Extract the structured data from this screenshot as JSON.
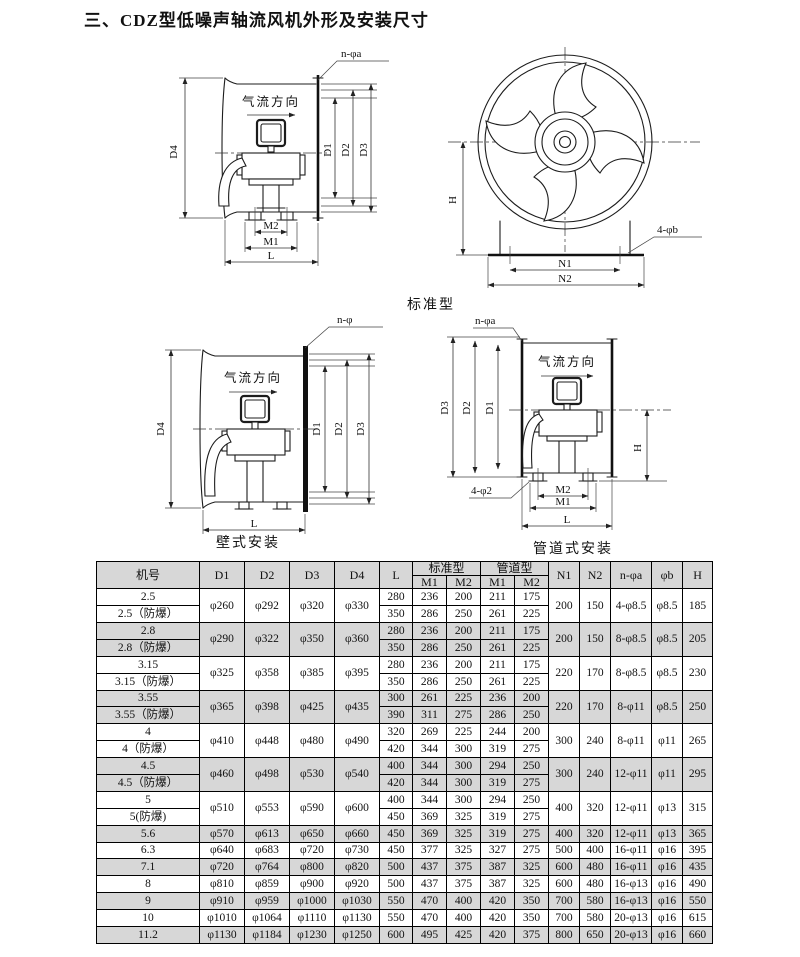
{
  "title": "三、CDZ型低噪声轴流风机外形及安装尺寸",
  "captions": {
    "standard": "标准型",
    "wall": "壁式安装",
    "duct": "管道式安装"
  },
  "labels": {
    "airflow": "气流方向",
    "std": {
      "bolt": "n-φa",
      "d4": "D4",
      "d1": "D1",
      "d2": "D2",
      "d3": "D3",
      "m2": "M2",
      "m1": "M1",
      "l": "L"
    },
    "front": {
      "h": "H",
      "n1": "N1",
      "n2": "N2",
      "bolt": "4-φb"
    },
    "wall": {
      "bolt": "n-φ",
      "d4": "D4",
      "d1": "D1",
      "d2": "D2",
      "d3": "D3",
      "l": "L"
    },
    "duct": {
      "bolt_top": "n-φa",
      "bolt_bottom": "4-φ2",
      "d3": "D3",
      "d2": "D2",
      "d1": "D1",
      "h": "H",
      "m2": "M2",
      "m1": "M1",
      "l": "L"
    }
  },
  "table": {
    "header": {
      "machine": "机号",
      "d1": "D1",
      "d2": "D2",
      "d3": "D3",
      "d4": "D4",
      "l": "L",
      "standard": "标准型",
      "duct": "管道型",
      "m1": "M1",
      "m2": "M2",
      "n1": "N1",
      "n2": "N2",
      "na": "n-φa",
      "b": "φb",
      "h": "H"
    },
    "groups": [
      {
        "names": [
          "2.5",
          "2.5（防爆）"
        ],
        "d": [
          "φ260",
          "φ292",
          "φ320",
          "φ330"
        ],
        "rows": [
          [
            "280",
            "236",
            "200",
            "211",
            "175"
          ],
          [
            "350",
            "286",
            "250",
            "261",
            "225"
          ]
        ],
        "n1": "200",
        "n2": "150",
        "na": "4-φ8.5",
        "b": "φ8.5",
        "h": "185",
        "shaded": false
      },
      {
        "names": [
          "2.8",
          "2.8（防爆）"
        ],
        "d": [
          "φ290",
          "φ322",
          "φ350",
          "φ360"
        ],
        "rows": [
          [
            "280",
            "236",
            "200",
            "211",
            "175"
          ],
          [
            "350",
            "286",
            "250",
            "261",
            "225"
          ]
        ],
        "n1": "200",
        "n2": "150",
        "na": "8-φ8.5",
        "b": "φ8.5",
        "h": "205",
        "shaded": true
      },
      {
        "names": [
          "3.15",
          "3.15（防爆）"
        ],
        "d": [
          "φ325",
          "φ358",
          "φ385",
          "φ395"
        ],
        "rows": [
          [
            "280",
            "236",
            "200",
            "211",
            "175"
          ],
          [
            "350",
            "286",
            "250",
            "261",
            "225"
          ]
        ],
        "n1": "220",
        "n2": "170",
        "na": "8-φ8.5",
        "b": "φ8.5",
        "h": "230",
        "shaded": false
      },
      {
        "names": [
          "3.55",
          "3.55（防爆）"
        ],
        "d": [
          "φ365",
          "φ398",
          "φ425",
          "φ435"
        ],
        "rows": [
          [
            "300",
            "261",
            "225",
            "236",
            "200"
          ],
          [
            "390",
            "311",
            "275",
            "286",
            "250"
          ]
        ],
        "n1": "220",
        "n2": "170",
        "na": "8-φ11",
        "b": "φ8.5",
        "h": "250",
        "shaded": true
      },
      {
        "names": [
          "4",
          "4（防爆）"
        ],
        "d": [
          "φ410",
          "φ448",
          "φ480",
          "φ490"
        ],
        "rows": [
          [
            "320",
            "269",
            "225",
            "244",
            "200"
          ],
          [
            "420",
            "344",
            "300",
            "319",
            "275"
          ]
        ],
        "n1": "300",
        "n2": "240",
        "na": "8-φ11",
        "b": "φ11",
        "h": "265",
        "shaded": false
      },
      {
        "names": [
          "4.5",
          "4.5（防爆）"
        ],
        "d": [
          "φ460",
          "φ498",
          "φ530",
          "φ540"
        ],
        "rows": [
          [
            "400",
            "344",
            "300",
            "294",
            "250"
          ],
          [
            "420",
            "344",
            "300",
            "319",
            "275"
          ]
        ],
        "n1": "300",
        "n2": "240",
        "na": "12-φ11",
        "b": "φ11",
        "h": "295",
        "shaded": true
      },
      {
        "names": [
          "5",
          "5(防爆)"
        ],
        "d": [
          "φ510",
          "φ553",
          "φ590",
          "φ600"
        ],
        "rows": [
          [
            "400",
            "344",
            "300",
            "294",
            "250"
          ],
          [
            "450",
            "369",
            "325",
            "319",
            "275"
          ]
        ],
        "n1": "400",
        "n2": "320",
        "na": "12-φ11",
        "b": "φ13",
        "h": "315",
        "shaded": false
      },
      {
        "names": [
          "5.6"
        ],
        "d": [
          "φ570",
          "φ613",
          "φ650",
          "φ660"
        ],
        "rows": [
          [
            "450",
            "369",
            "325",
            "319",
            "275"
          ]
        ],
        "n1": "400",
        "n2": "320",
        "na": "12-φ11",
        "b": "φ13",
        "h": "365",
        "shaded": true
      },
      {
        "names": [
          "6.3"
        ],
        "d": [
          "φ640",
          "φ683",
          "φ720",
          "φ730"
        ],
        "rows": [
          [
            "450",
            "377",
            "325",
            "327",
            "275"
          ]
        ],
        "n1": "500",
        "n2": "400",
        "na": "16-φ11",
        "b": "φ16",
        "h": "395",
        "shaded": false
      },
      {
        "names": [
          "7.1"
        ],
        "d": [
          "φ720",
          "φ764",
          "φ800",
          "φ820"
        ],
        "rows": [
          [
            "500",
            "437",
            "375",
            "387",
            "325"
          ]
        ],
        "n1": "600",
        "n2": "480",
        "na": "16-φ11",
        "b": "φ16",
        "h": "435",
        "shaded": true
      },
      {
        "names": [
          "8"
        ],
        "d": [
          "φ810",
          "φ859",
          "φ900",
          "φ920"
        ],
        "rows": [
          [
            "500",
            "437",
            "375",
            "387",
            "325"
          ]
        ],
        "n1": "600",
        "n2": "480",
        "na": "16-φ13",
        "b": "φ16",
        "h": "490",
        "shaded": false
      },
      {
        "names": [
          "9"
        ],
        "d": [
          "φ910",
          "φ959",
          "φ1000",
          "φ1030"
        ],
        "rows": [
          [
            "550",
            "470",
            "400",
            "420",
            "350"
          ]
        ],
        "n1": "700",
        "n2": "580",
        "na": "16-φ13",
        "b": "φ16",
        "h": "550",
        "shaded": true
      },
      {
        "names": [
          "10"
        ],
        "d": [
          "φ1010",
          "φ1064",
          "φ1110",
          "φ1130"
        ],
        "rows": [
          [
            "550",
            "470",
            "400",
            "420",
            "350"
          ]
        ],
        "n1": "700",
        "n2": "580",
        "na": "20-φ13",
        "b": "φ16",
        "h": "615",
        "shaded": false
      },
      {
        "names": [
          "11.2"
        ],
        "d": [
          "φ1130",
          "φ1184",
          "φ1230",
          "φ1250"
        ],
        "rows": [
          [
            "600",
            "495",
            "425",
            "420",
            "375"
          ]
        ],
        "n1": "800",
        "n2": "650",
        "na": "20-φ13",
        "b": "φ16",
        "h": "660",
        "shaded": true
      }
    ]
  }
}
